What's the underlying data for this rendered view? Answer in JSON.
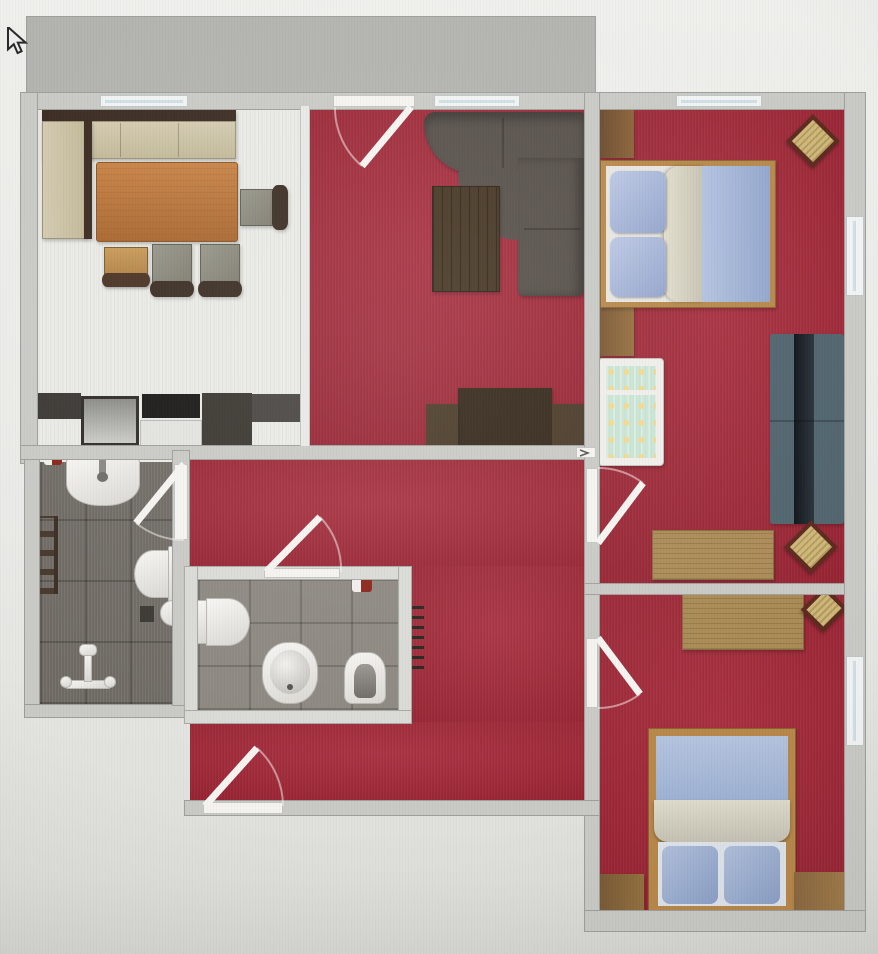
{
  "app": {
    "type": "floor-plan-top-view",
    "visible_text": [],
    "cursor": {
      "icon": "arrow-cursor",
      "x": 8,
      "y": 30
    }
  },
  "palette": {
    "background": "#e9e9e6",
    "wall": "#c9c9c5",
    "carpet_red": "#a42334",
    "kitchen_floor": "#eaeae6",
    "bathroom_tile": "#6e6963",
    "wc_tile": "#8a857e",
    "deck_wood": "#dfb66c",
    "dining_table_wood": "#b5713a",
    "bench_beige": "#cfc6a8",
    "sofa_dark": "#57504a",
    "sofa_blue": "#51656f",
    "bed_frame_wood": "#b8884a",
    "bedding_blue": "#a9bcd8",
    "blanket_beige": "#d8d4c6",
    "desk_wood": "#ab8c58",
    "crib_fabric_mint": "#cfe6d8",
    "fixture_white": "#f2f1ee",
    "door_leaf": "#f6f4f0"
  },
  "rooms": {
    "deck": {
      "label": "Balcony deck"
    },
    "kitchen_dining": {
      "label": "Kitchen / dining room",
      "furniture": [
        "corner bench",
        "dining table",
        "3 chairs",
        "stool",
        "kitchen counter with oven, cooktop, cabinets"
      ]
    },
    "living_room": {
      "label": "Living room",
      "furniture": [
        "curved corner sofa",
        "coffee table",
        "TV sideboard"
      ]
    },
    "bedroom_large": {
      "label": "Large bedroom / kids room",
      "furniture": [
        "double bed",
        "wardrobe",
        "baby crib",
        "sofa",
        "desk",
        "2 chairs"
      ]
    },
    "bedroom_small": {
      "label": "Small bedroom",
      "furniture": [
        "desk",
        "chair",
        "single bed",
        "2 wardrobes"
      ]
    },
    "hallway": {
      "label": "Hallway",
      "furniture": [
        "radiator"
      ]
    },
    "bathroom": {
      "label": "Bathroom",
      "furniture": [
        "washbasin",
        "towel radiator",
        "toilet",
        "stool",
        "toilet paper holder",
        "shower fixture",
        "decor item"
      ]
    },
    "wc": {
      "label": "WC",
      "furniture": [
        "toilet",
        "bidet",
        "urinal",
        "decor item"
      ]
    }
  },
  "furniture": {
    "corner_bench": "Corner bench",
    "dining_table": "Dining table",
    "dining_chair": "Dining chair",
    "stool_chair": "Wooden stool chair",
    "kitchen_counter": "Kitchen counter",
    "oven": "Oven",
    "cooktop": "Cooktop",
    "tall_unit": "Tall kitchen unit",
    "corner_sofa": "Curved corner sofa",
    "coffee_table": "Coffee table",
    "tv_sideboard": "TV sideboard",
    "double_bed": "Double bed",
    "wardrobe": "Wardrobe",
    "baby_crib": "Baby crib",
    "blue_sofa": "Sofa",
    "desk": "Desk",
    "rotated_chair": "Chair",
    "single_bed": "Single bed",
    "washbasin": "Washbasin",
    "toilet": "Toilet",
    "bidet": "Bidet",
    "urinal": "Urinal",
    "shower_fixture": "Shower fixture",
    "towel_radiator": "Towel radiator",
    "radiator": "Radiator",
    "round_stool": "Round stool",
    "paper_holder": "Toilet paper holder",
    "decor_item": "Decor item"
  },
  "openings": {
    "doors": [
      "balcony door",
      "bathroom door",
      "wc door",
      "large bedroom door",
      "small bedroom door",
      "entrance door"
    ],
    "windows": [
      "kitchen window",
      "living room window",
      "bedroom top window",
      "right wall window upper",
      "right wall window lower"
    ]
  }
}
